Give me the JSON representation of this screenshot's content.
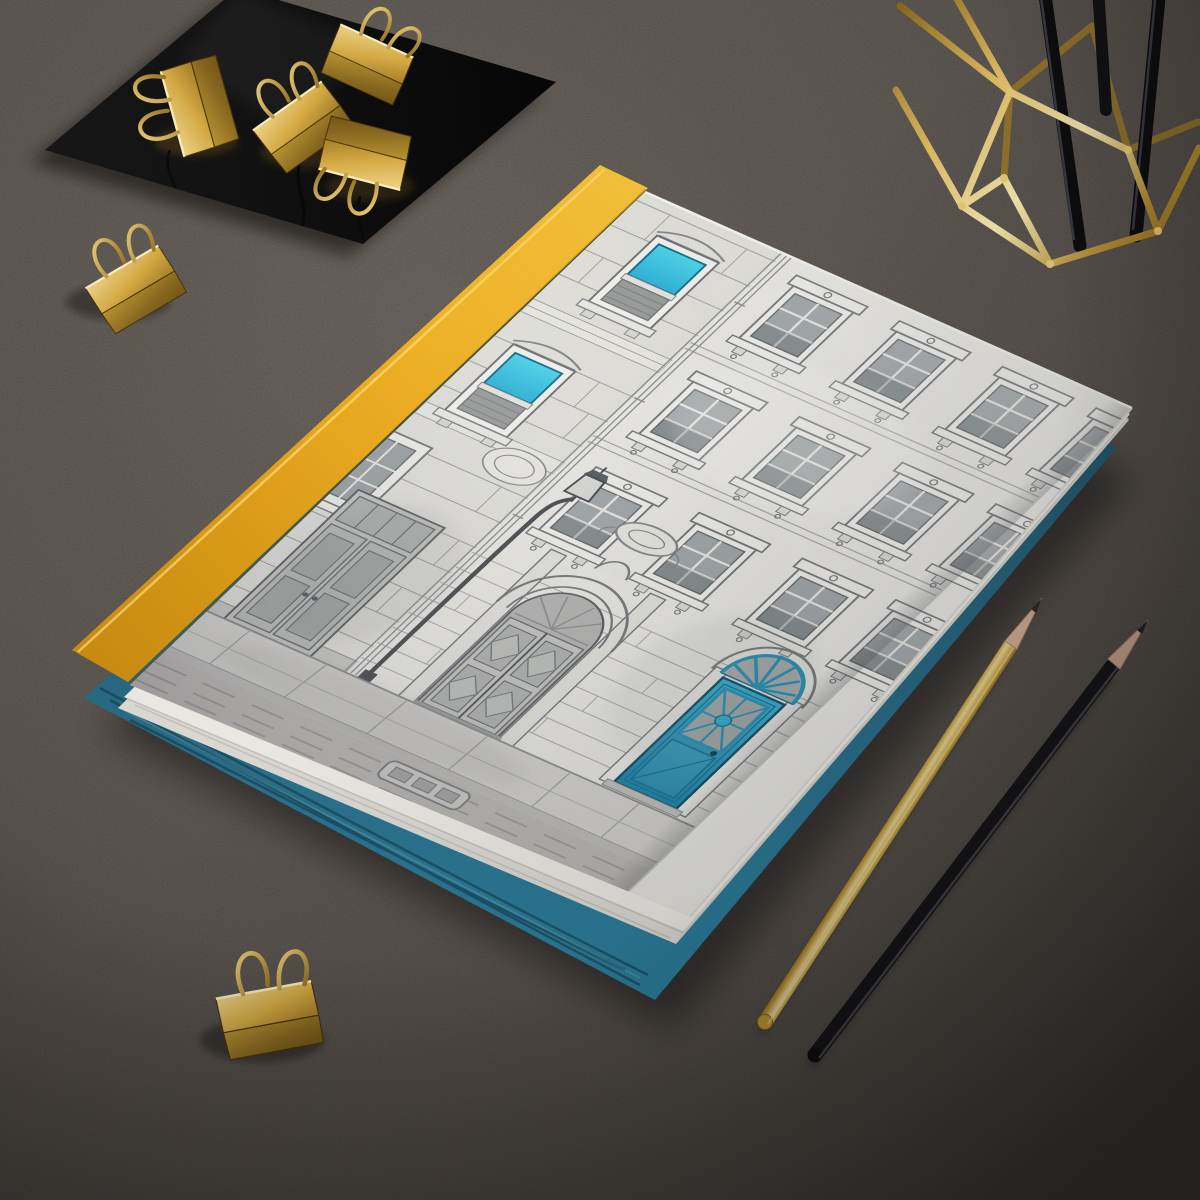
{
  "meta": {
    "kind": "product-photo-mockup",
    "canvas": "1200x1200",
    "description": "Hardcover journal with hand-drawn building-facade cover art lying on a dark textured leather desk, surrounded by gold stationery props"
  },
  "scene": {
    "surface": {
      "label": "dark gray leather desk",
      "color": "#56504b"
    },
    "journal": {
      "label": "hardcover journal, matte",
      "spine_color": "#eeb12e",
      "cover_paper_color": "#ebeae6",
      "page_edge_color": "#f2f1ec",
      "cover_art": "pen-and-wash European building facade",
      "art_accents": [
        "teal glass windows",
        "blue paneled entry door with fanlight",
        "arched wooden double door",
        "street lamp",
        "stone sidewalk",
        "drain grate"
      ]
    },
    "under_book": {
      "label": "teal hardcover book underneath",
      "color": "#2b7795"
    },
    "black_card": {
      "label": "glossy black square card",
      "color": "#0e0e0e"
    },
    "binder_clips": {
      "label": "gold binder clips",
      "count": 6,
      "color": "#d4a73c",
      "locations": [
        "four on black card",
        "one beside card",
        "one bottom left"
      ]
    },
    "pen_holder": {
      "label": "gold geometric wire pen cup",
      "color": "#d9b050",
      "contents": "black pens"
    },
    "pencils": [
      {
        "label": "gold pencil",
        "color": "#c89a33"
      },
      {
        "label": "black pencil",
        "color": "#17171a"
      }
    ]
  },
  "colors": {
    "leather": "#56504b",
    "accent_yellow": "#eeb12e",
    "accent_teal": "#2fb3d8",
    "teal_book": "#2b7795",
    "gold": "#d4a73c",
    "paper": "#ebeae6",
    "ink": "#6e7276",
    "card_black": "#0e0e0e"
  }
}
